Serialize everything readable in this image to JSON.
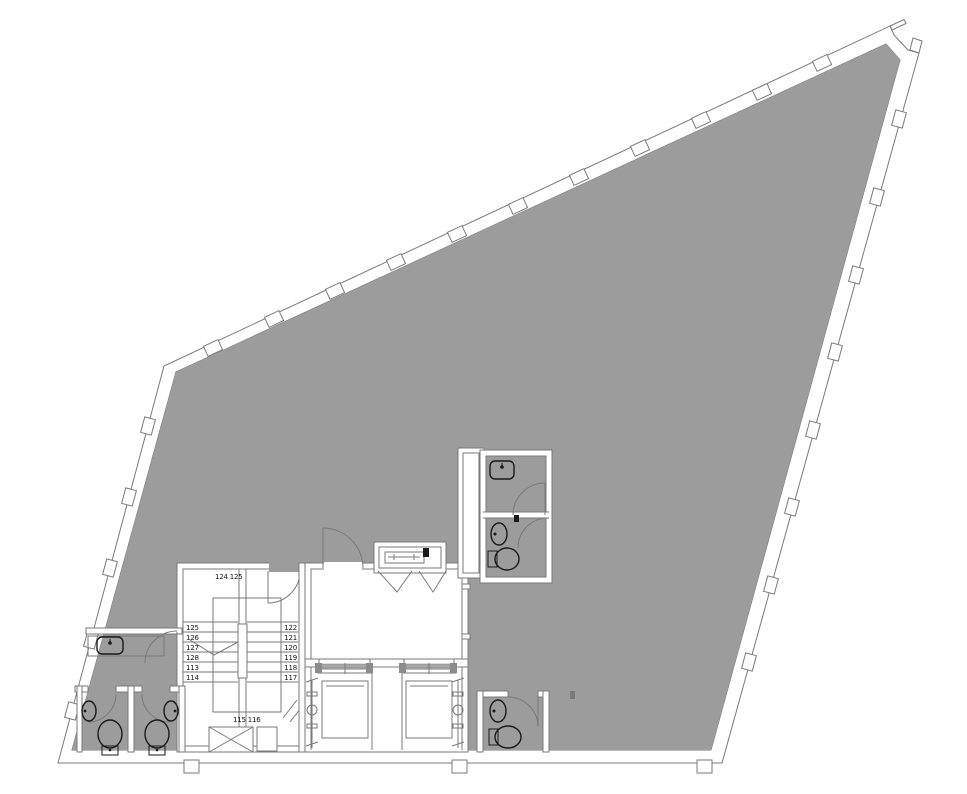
{
  "colors": {
    "floor": "#9c9c9c",
    "wall_line": "#7a7a7a",
    "fixture": "#1a1a1a",
    "paper": "#ffffff"
  },
  "stairwell": {
    "top_steps_label": "124 125",
    "bottom_steps_label": "115 116",
    "left_flight_steps": [
      "125",
      "126",
      "127",
      "128",
      "113",
      "114"
    ],
    "right_flight_steps": [
      "122",
      "121",
      "120",
      "119",
      "118",
      "117"
    ]
  },
  "icons": {
    "toilet": "ellipse-with-tank",
    "sink": "oval-basin-with-faucet-dot",
    "elevator_car": "open-rectangle-with-sling",
    "door": "quarter-arc-swing",
    "window_mullion": "wall-straddle-tab",
    "shaft": "x-crossed-box"
  }
}
